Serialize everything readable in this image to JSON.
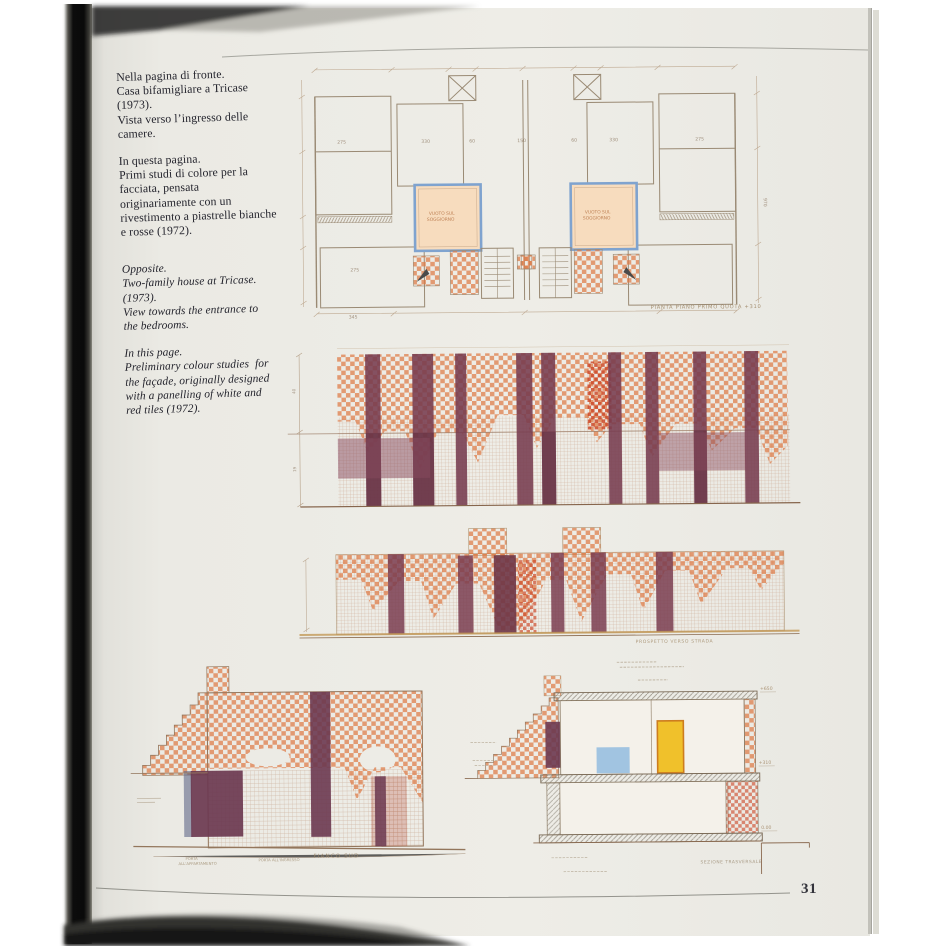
{
  "page": {
    "number": "31",
    "paper_color": "#e9e8e2",
    "checker_color": "#de7a46",
    "dense_red_color": "#cc4526",
    "maroon_color": "#763b4e",
    "blue_frame_color": "#7fa3cf",
    "yellow_door_color": "#f0c12b",
    "lightblue_color": "#92bcdf"
  },
  "captions": {
    "italian_1": "Nella pagina di fronte.\nCasa bifamigliare a Tricase\n(1973).\nVista verso l’ingresso delle\ncamere.",
    "italian_2": "In questa pagina.\nPrimi studi di colore per la\nfacciata, pensata\noriginariamente con un\nrivestimento a piastrelle bianche\ne rosse (1972).",
    "english_1": "Opposite.\nTwo-family house at Tricase.\n(1973).\nView towards the entrance to\nthe bedrooms.",
    "english_2": "In this page.\nPreliminary colour studies  for\nthe façade, originally designed\nwith a panelling of white and\nred tiles (1972)."
  },
  "plan": {
    "caption": "PIANTA  PIANO  PRIMO   QUOTA +310",
    "void_line1": "VUOTO SUL",
    "void_line2": "SOGGIORNO",
    "dims": [
      "275",
      "330",
      "60",
      "150",
      "60",
      "330",
      "275",
      "275",
      "345",
      "970"
    ]
  },
  "elev1": {
    "dims": [
      "40",
      "19"
    ]
  },
  "elev2": {
    "caption": "PROSPETTO VERSO STRADA"
  },
  "fianco": {
    "caption": "FIANCO  SUD",
    "note_1": "PORTA",
    "note_2": "ALL'APPARTAMENTO",
    "note_3": "PORTA ALL'INGRESSO"
  },
  "section": {
    "caption": "SEZIONE TRASVERSALE",
    "levels": [
      "+650",
      "+310",
      "0.00"
    ]
  }
}
